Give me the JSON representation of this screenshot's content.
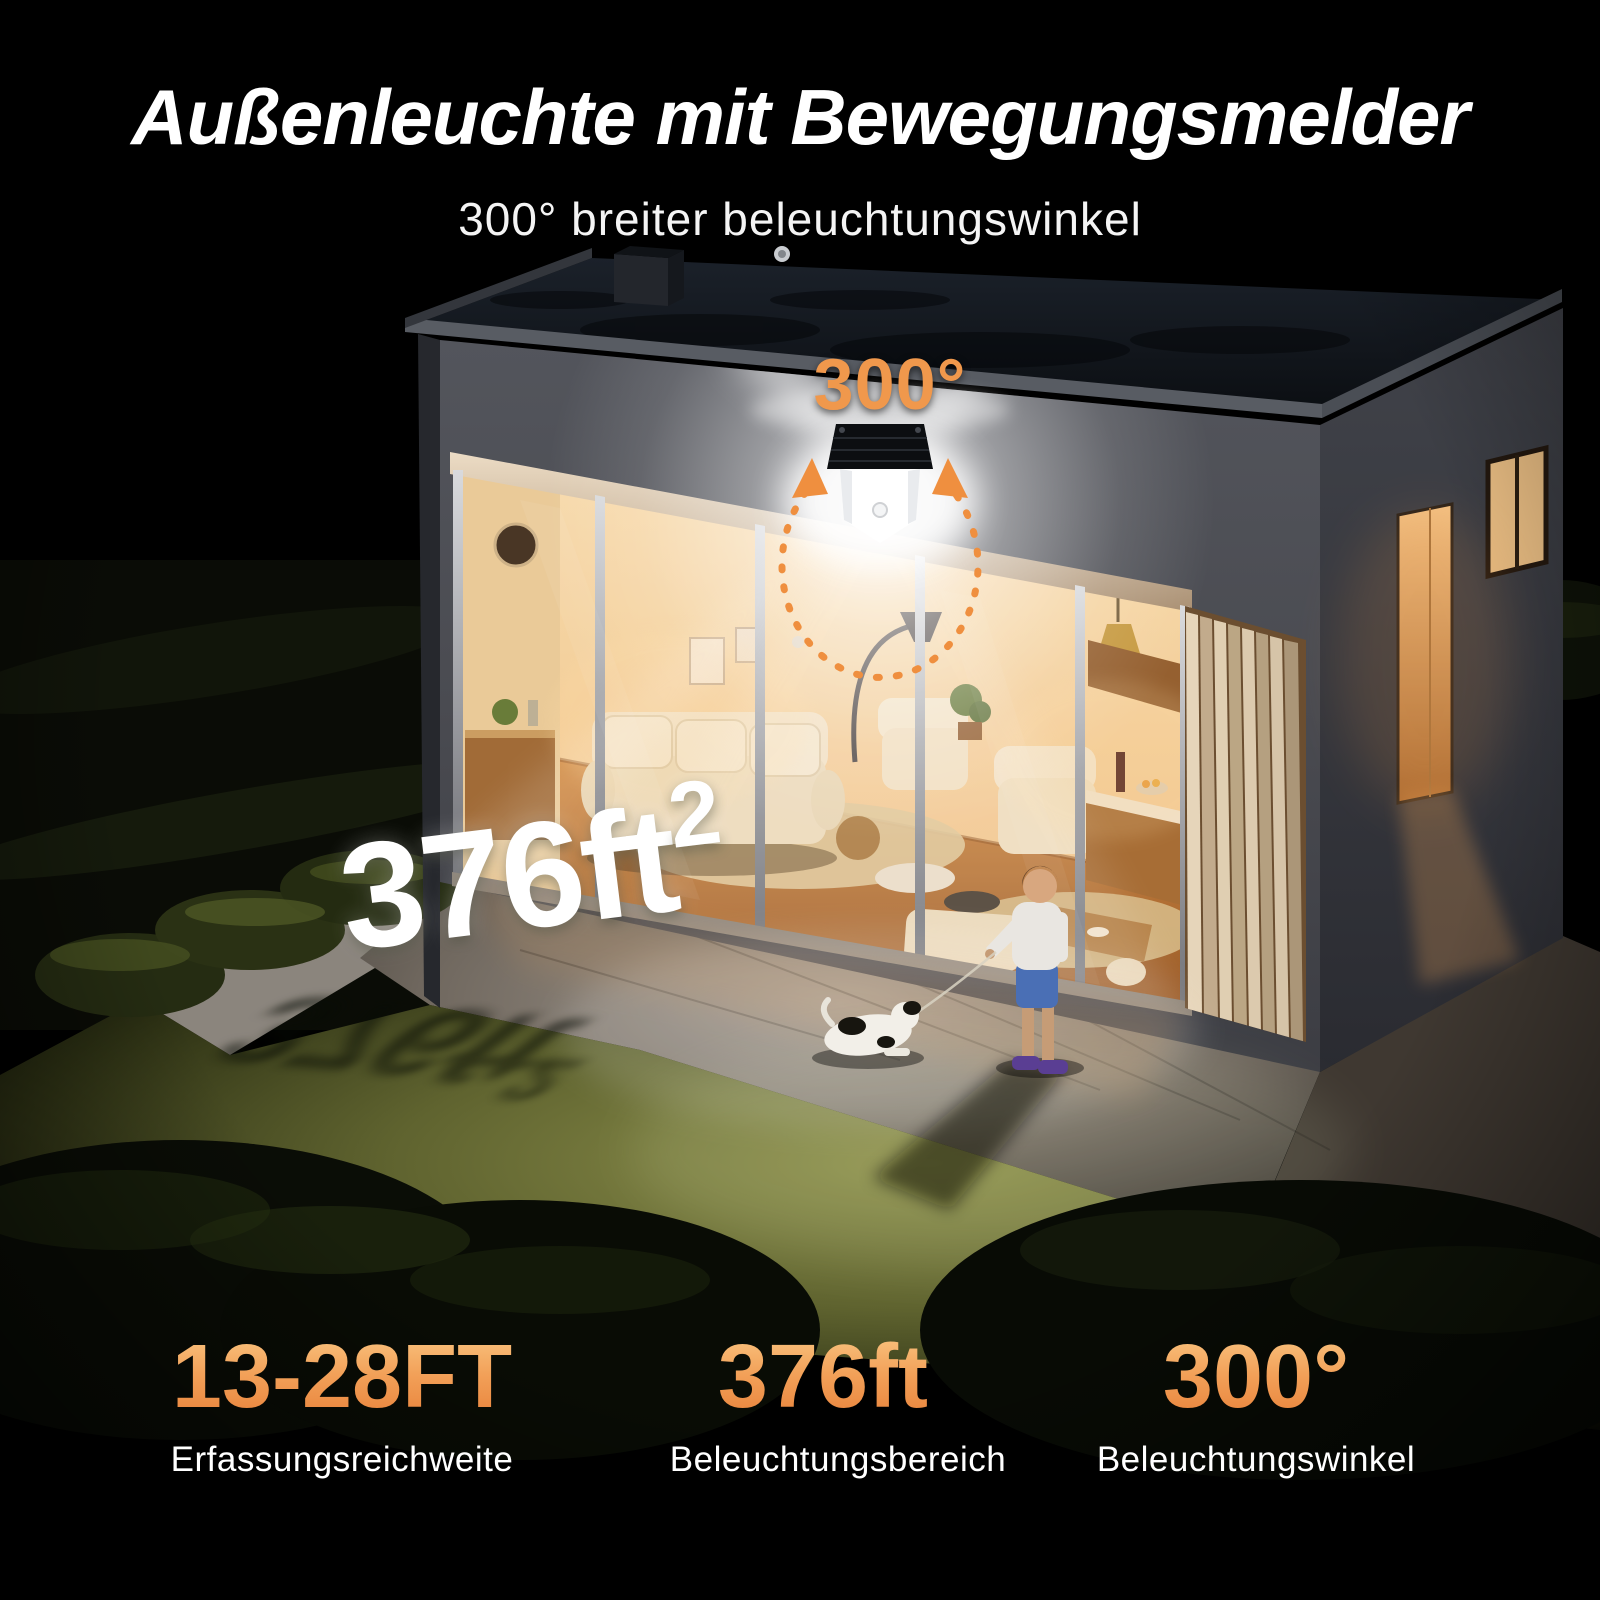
{
  "header": {
    "title": "Außenleuchte mit Bewegungsmelder",
    "subtitle": "300° breiter beleuchtungswinkel"
  },
  "scene": {
    "angle_label": "300°",
    "area_value": "376ft",
    "area_sup": "2"
  },
  "stats": [
    {
      "value": "13-28FT",
      "sup": "",
      "label": "Erfassungsreichweite"
    },
    {
      "value": "376ft",
      "sup": "2",
      "label": "Beleuchtungsbereich"
    },
    {
      "value": "300°",
      "sup": "",
      "label": "Beleuchtungswinkel"
    }
  ],
  "colors": {
    "accent_orange": "#F0984C",
    "accent_gradient_top": "#F9C480",
    "accent_gradient_bottom": "#E8823A",
    "headline_white": "#FFFFFF",
    "background": "#000000"
  }
}
